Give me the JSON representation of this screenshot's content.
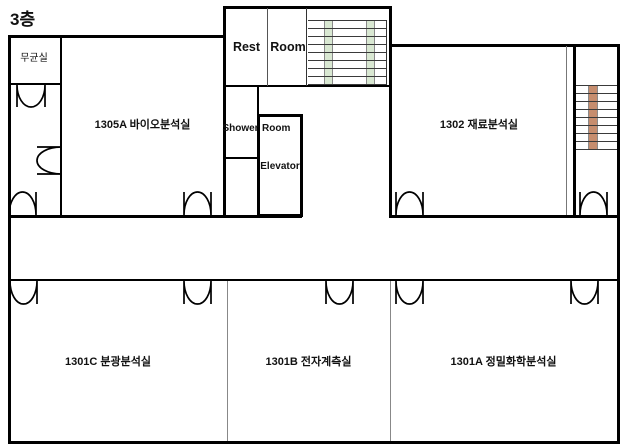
{
  "title": "3층",
  "rooms": {
    "sterile": "무균실",
    "bio": "1305A 바이오분석실",
    "rest": "Rest",
    "rest2": "Room",
    "shower": "Shower",
    "shower2": "Room",
    "elevator": "Elevator",
    "material": "1302  재료분석실",
    "spectroscopy": "1301C 분광분석실",
    "electronic": "1301B 전자계측실",
    "precision": "1301A  정밀화학분석실"
  },
  "colors": {
    "wall": "#000000",
    "stair_stripe_green": "#d9e8d2",
    "stair_stripe_brown": "#c68d6e",
    "tread_line": "#3a3a3a"
  }
}
